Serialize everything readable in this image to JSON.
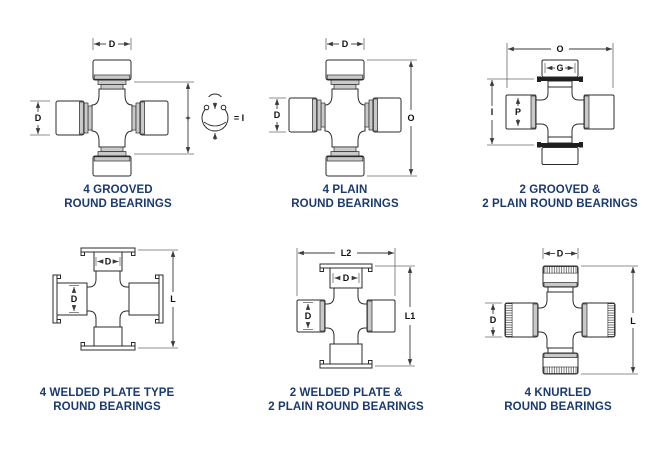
{
  "colors": {
    "caption": "#1a3a70",
    "line": "#2b2b2b",
    "shade": "#c9c9c9",
    "background": "#ffffff"
  },
  "diagrams": [
    {
      "caption_line1": "4 GROOVED",
      "caption_line2": "ROUND BEARINGS",
      "dims": {
        "top": "D",
        "left": "D",
        "plus": "+",
        "equals": "= I"
      }
    },
    {
      "caption_line1": "4 PLAIN",
      "caption_line2": "ROUND BEARINGS",
      "dims": {
        "top": "D",
        "left": "D",
        "overall": "O"
      }
    },
    {
      "caption_line1": "2 GROOVED &",
      "caption_line2": "2 PLAIN ROUND BEARINGS",
      "dims": {
        "overall": "O",
        "cap": "G",
        "inside": "I",
        "cup": "P"
      }
    },
    {
      "caption_line1": "4 WELDED PLATE TYPE",
      "caption_line2": "ROUND BEARINGS",
      "dims": {
        "top_cup": "D",
        "left_cup": "D",
        "length": "L"
      }
    },
    {
      "caption_line1": "2 WELDED PLATE &",
      "caption_line2": "2 PLAIN ROUND BEARINGS",
      "dims": {
        "width": "L2",
        "top_cup": "D",
        "left_cup": "D",
        "length": "L1"
      }
    },
    {
      "caption_line1": "4 KNURLED",
      "caption_line2": "ROUND BEARINGS",
      "dims": {
        "top": "D",
        "left": "D",
        "length": "L"
      }
    }
  ]
}
